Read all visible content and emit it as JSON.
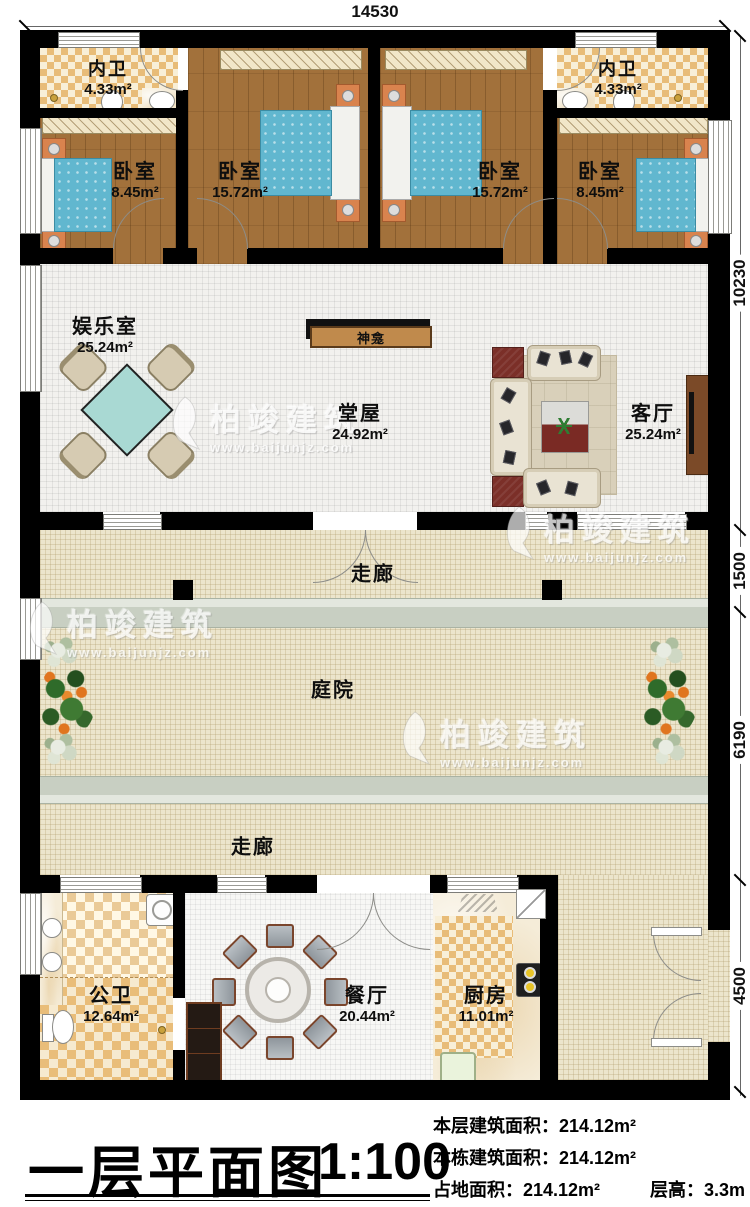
{
  "dimensions": {
    "top": "14530",
    "right": [
      "10230",
      "1500",
      "6190",
      "4500"
    ]
  },
  "rooms": [
    {
      "id": "neiwei-left",
      "label": "内卫",
      "area": "4.33m²"
    },
    {
      "id": "bedroom-1",
      "label": "卧室",
      "area": "8.45m²"
    },
    {
      "id": "bedroom-2",
      "label": "卧室",
      "area": "15.72m²"
    },
    {
      "id": "bedroom-3",
      "label": "卧室",
      "area": "15.72m²"
    },
    {
      "id": "bedroom-4",
      "label": "卧室",
      "area": "8.45m²"
    },
    {
      "id": "neiwei-right",
      "label": "内卫",
      "area": "4.33m²"
    },
    {
      "id": "yuleshi",
      "label": "娱乐室",
      "area": "25.24m²"
    },
    {
      "id": "tangwu",
      "label": "堂屋",
      "area": "24.92m²"
    },
    {
      "id": "keting",
      "label": "客厅",
      "area": "25.24m²"
    },
    {
      "id": "gongwei",
      "label": "公卫",
      "area": "12.64m²"
    },
    {
      "id": "canting",
      "label": "餐厅",
      "area": "20.44m²"
    },
    {
      "id": "chufang",
      "label": "厨房",
      "area": "11.01m²"
    }
  ],
  "labels": {
    "shrine": "神龛",
    "corridor_upper": "走廊",
    "corridor_lower": "走廊",
    "courtyard": "庭院"
  },
  "title_block": {
    "title": "一层平面图",
    "scale": "1:100",
    "info": [
      "本层建筑面积：214.12m²",
      "本栋建筑面积：214.12m²",
      "占地面积：214.12m²",
      "层高：3.3m"
    ]
  },
  "watermark": {
    "brand": "柏竣建筑",
    "url": "www.baijunjz.com"
  },
  "colors": {
    "wall": "#000000",
    "bedroom_floor": "#a2713b",
    "bath_tile": "#e8bc78",
    "corridor_tile": "#ece5cc",
    "bed": "#61b7cf",
    "shrine_bar": "#c08a4c",
    "walk_band": "#c8cfc2"
  }
}
